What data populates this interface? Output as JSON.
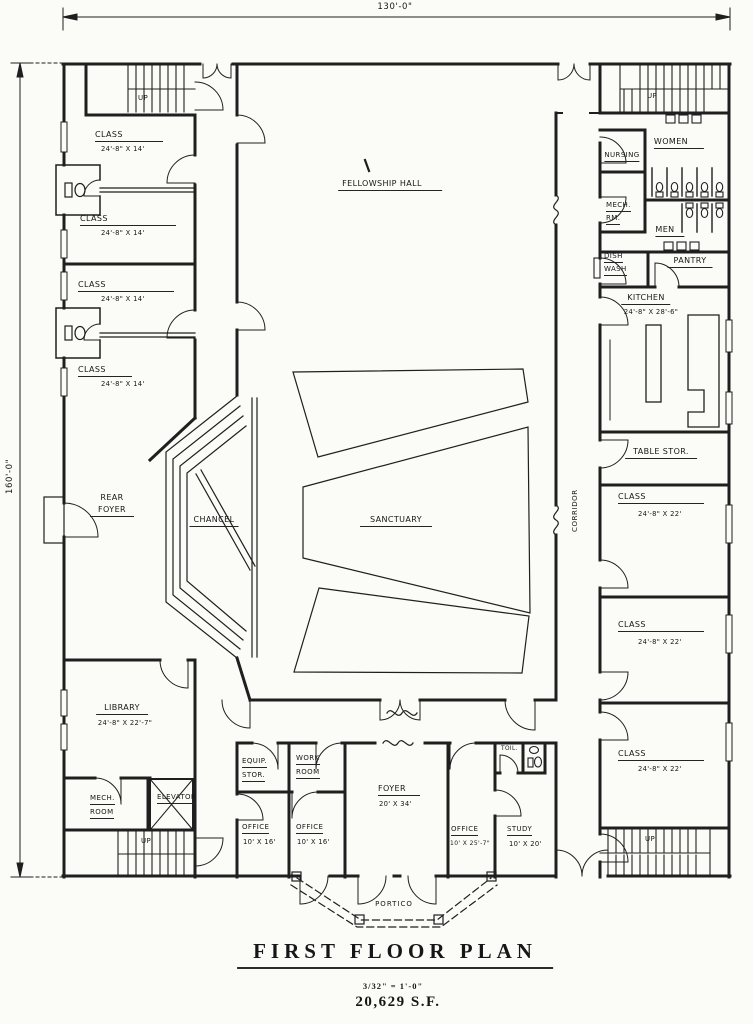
{
  "drawing": {
    "type": "architectural floor plan",
    "line_color": "#1f1f1f",
    "paper_color": "#fbfbf8"
  },
  "title_block": {
    "title": "FIRST  FLOOR  PLAN",
    "scale": "3/32\" = 1'-0\"",
    "area": "20,629 S.F."
  },
  "dimensions": {
    "overall_width": "130'-0\"",
    "overall_height": "160'-0\""
  },
  "stairs": {
    "up_label": "UP"
  },
  "rooms": {
    "fellowship_hall": {
      "name": "FELLOWSHIP HALL"
    },
    "sanctuary": {
      "name": "SANCTUARY"
    },
    "chancel": {
      "name": "CHANCEL"
    },
    "rear_foyer": {
      "name": "REAR",
      "name2": "FOYER"
    },
    "corridor": {
      "name": "CORRIDOR"
    },
    "class_nw1": {
      "name": "CLASS",
      "size": "24'-8\" X 14'"
    },
    "class_nw2": {
      "name": "CLASS",
      "size": "24'-8\" X 14'"
    },
    "class_nw3": {
      "name": "CLASS",
      "size": "24'-8\" X 14'"
    },
    "class_nw4": {
      "name": "CLASS",
      "size": "24'-8\" X 14'"
    },
    "nursing": {
      "name": "NURSING"
    },
    "mech_rm": {
      "name": "MECH.",
      "name2": "RM."
    },
    "women": {
      "name": "WOMEN"
    },
    "men": {
      "name": "MEN"
    },
    "dish_wash": {
      "name": "DISH",
      "name2": "WASH"
    },
    "pantry": {
      "name": "PANTRY"
    },
    "kitchen": {
      "name": "KITCHEN",
      "size": "24'-8\" X 28'-6\""
    },
    "table_stor": {
      "name": "TABLE STOR."
    },
    "class_e1": {
      "name": "CLASS",
      "size": "24'-8\" X 22'"
    },
    "class_e2": {
      "name": "CLASS",
      "size": "24'-8\" X 22'"
    },
    "class_e3": {
      "name": "CLASS",
      "size": "24'-8\" X 22'"
    },
    "library": {
      "name": "LIBRARY",
      "size": "24'-8\" X 22'-7\""
    },
    "mech_room": {
      "name": "MECH.",
      "name2": "ROOM"
    },
    "elevator": {
      "name": "ELEVATOR"
    },
    "equip_stor": {
      "name": "EQUIP.",
      "name2": "STOR."
    },
    "work_room": {
      "name": "WORK",
      "name2": "ROOM"
    },
    "office_sw1": {
      "name": "OFFICE",
      "size": "10' X 16'"
    },
    "office_sw2": {
      "name": "OFFICE",
      "size": "10' X 16'"
    },
    "foyer": {
      "name": "FOYER",
      "size": "20' X 34'"
    },
    "office_s": {
      "name": "OFFICE",
      "size": "10' X 25'-7\""
    },
    "study": {
      "name": "STUDY",
      "size": "10' X 20'"
    },
    "toilet": {
      "name": "TOIL."
    },
    "portico": {
      "name": "PORTICO"
    }
  }
}
